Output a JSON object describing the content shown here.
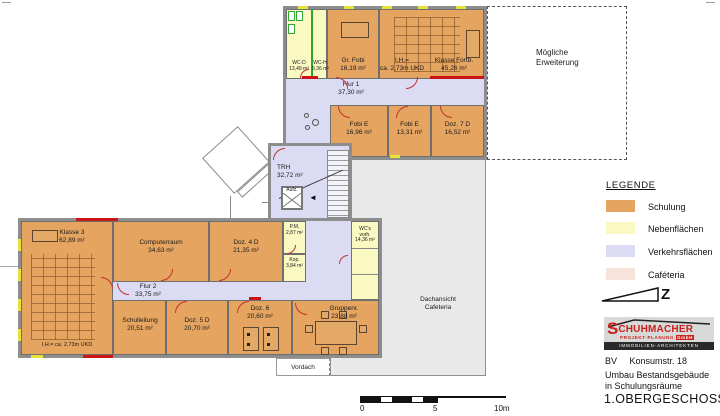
{
  "title_block": {
    "bv": "BV",
    "street": "Konsumstr. 18",
    "line1": "Umbau Bestandsgebäude",
    "line2": "in Schulungsräume",
    "floor": "1.OBERGESCHOSS"
  },
  "logo": {
    "s": "S",
    "rest": "CHUHMACHER",
    "sub1": "PROJEKT·PLANUNG",
    "sub1b": "GmbH",
    "sub2": "IMMOBILIEN-ARCHITEKTEN"
  },
  "legend": {
    "heading": "LEGENDE",
    "items": [
      {
        "label": "Schulung",
        "color": "#E5A45F"
      },
      {
        "label": "Nebenflächen",
        "color": "#FAF9C2"
      },
      {
        "label": "Verkehrsflächen",
        "color": "#DBDBF3"
      },
      {
        "label": "Caféteria",
        "color": "#F8E3DB"
      }
    ],
    "north_letter": "Z"
  },
  "annotations": {
    "expansion1": "Mögliche",
    "expansion2": "Erweiterung",
    "roof1": "Dachansicht",
    "roof2": "Cafeteria",
    "vordach": "Vordach"
  },
  "scalebar": {
    "zero": "0",
    "five": "5",
    "ten": "10m"
  },
  "rooms": {
    "wc_d": {
      "name": "WC-D",
      "area": "13,49 m²"
    },
    "wc_h": {
      "name": "WC-H",
      "area": "9,36 m²"
    },
    "gr_fobi": {
      "name": "Gr. Fobi",
      "area": "16,19 m²"
    },
    "klasse_fortb": {
      "name": "Klasse Fortb.",
      "area": "45,26 m²",
      "note1": "I.H.=",
      "note2": "ca. 2,73m UKD"
    },
    "flur_1": {
      "name": "Flur 1",
      "area": "37,30 m²"
    },
    "fobi_e_1": {
      "name": "Fobi E",
      "area": "16,96 m²"
    },
    "fobi_e_2": {
      "name": "Fobi E",
      "area": "13,31 m²"
    },
    "doz_7": {
      "name": "Doz. 7 D",
      "area": "16,52 m²"
    },
    "trh": {
      "name": "TRH",
      "area": "32,72 m²"
    },
    "aufzug": {
      "name": "Aufz."
    },
    "klasse_3": {
      "name": "Klasse 3",
      "area": "62,89 m²",
      "note": "I.H.= ca. 2,73m UKD"
    },
    "computerraum": {
      "name": "Computerraum",
      "area": "34,63 m²"
    },
    "doz_4": {
      "name": "Doz. 4 D",
      "area": "21,35 m²"
    },
    "pm": {
      "name": "P.M.",
      "area": "2,87 m²"
    },
    "kop": {
      "name": "Kop.",
      "area": "3,84 m²"
    },
    "wcs": {
      "name1": "WC's",
      "name2": "vorh.",
      "area": "14,36 m²"
    },
    "flur_2": {
      "name": "Flur 2",
      "area": "33,75 m²"
    },
    "schulleitung": {
      "name": "Schulleitung",
      "area": "20,51 m²"
    },
    "doz_5": {
      "name": "Doz. 5 D",
      "area": "20,70 m²"
    },
    "doz_6": {
      "name": "Doz. 6",
      "area": "20,60 m²"
    },
    "gruppenr": {
      "name": "Gruppenr.",
      "area": "23,88 m²"
    }
  }
}
